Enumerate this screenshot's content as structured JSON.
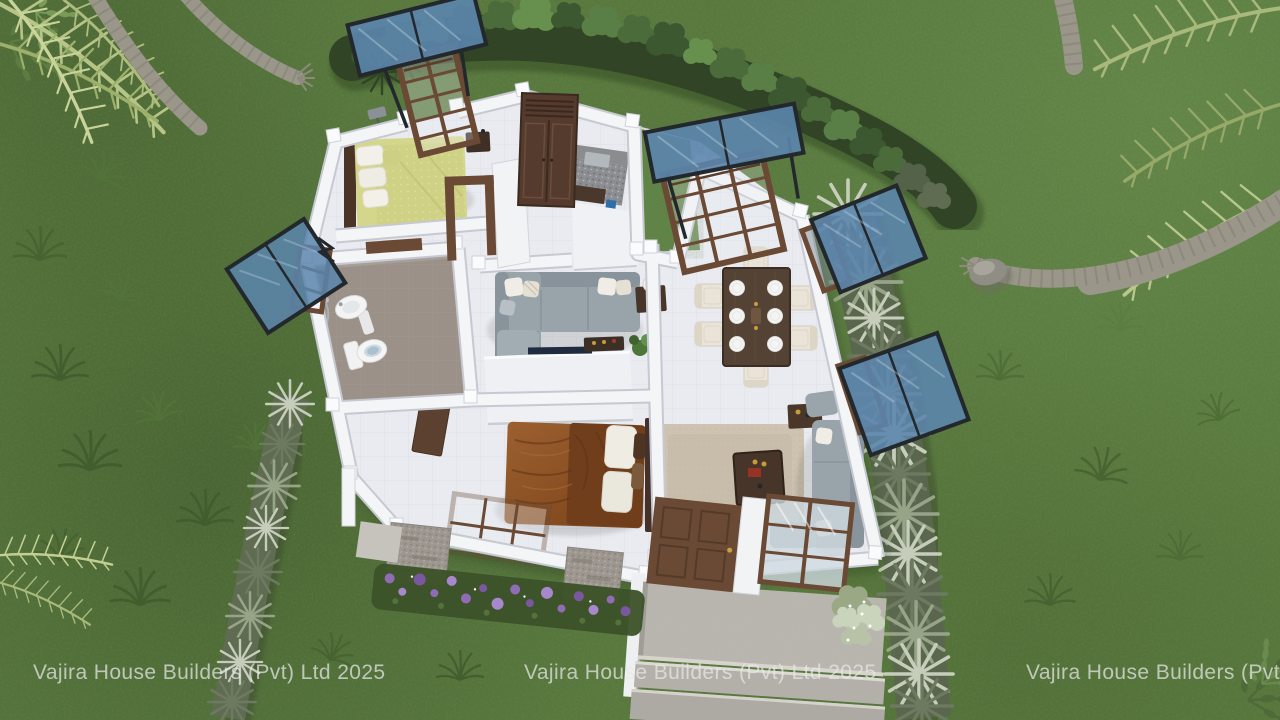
{
  "scene": {
    "kind": "3d-architectural-render",
    "subject": "Aerial cutaway view of a furnished single-storey house plan on a lawn with hedges, palm trees and blue glass window canopies"
  },
  "watermarks": [
    {
      "text": "Vajira House Builders (Pvt) Ltd 2025"
    },
    {
      "text": "Vajira House Builders (Pvt) Ltd 2025"
    },
    {
      "text": "Vajira House Builders (Pvt) Ltd 2025"
    }
  ],
  "palette": {
    "grass": "#587a3d",
    "grass-dark": "#42592b",
    "grass-bright": "#6b9150",
    "hedge": "#3d5830",
    "hedge-light": "#5d8048",
    "silver-grass": "#9aa68c",
    "silver-grass-dark": "#5f6c52",
    "palm-trunk": "#9a978a",
    "palm-frond": "#aebc7e",
    "wall": "#f3f4f6",
    "wall-shade": "#c7cad2",
    "floor": "#e9ebf0",
    "floor-bath": "#9b9189",
    "floor-kitchen": "#94959a",
    "canopy-glass": "#5b85ad",
    "canopy-frame": "#23282c",
    "wood-frame": "#6b4a35",
    "wardrobe": "#553b2d",
    "bed-yellow": "#d4d78b",
    "bed-rust": "#8e5526",
    "blanket-rust": "#713e1b",
    "sofa": "#99a3aa",
    "dining-wood": "#544334",
    "chair-cream": "#e9e4d7",
    "rug": "#cdc3b0",
    "concrete": "#b8b5af",
    "flower-purple": "#8f6cb4",
    "stone": "#9d978f",
    "watermark-color": "#e9e9e9"
  }
}
